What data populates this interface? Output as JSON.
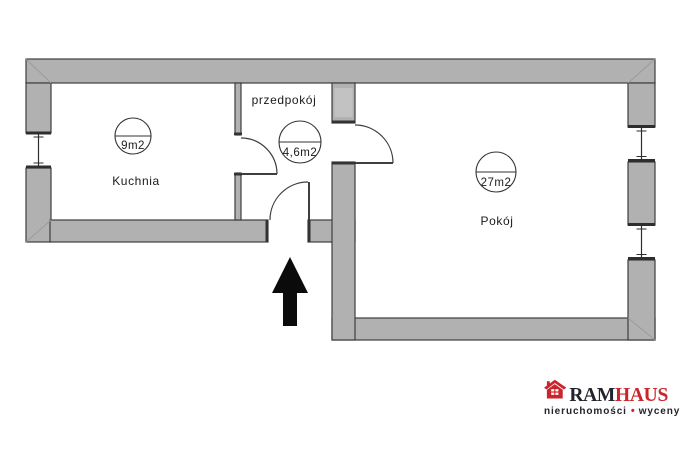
{
  "diagram": {
    "type": "floor-plan",
    "rooms": {
      "kitchen": {
        "name": "Kuchnia",
        "area": "9m2"
      },
      "hallway": {
        "name": "przedpokój",
        "area": "4,6m2"
      },
      "room": {
        "name": "Pokój",
        "area": "27m2"
      }
    },
    "icons": {
      "entrance_arrow": "arrow-up"
    },
    "colors": {
      "wall_fill": "#b1b1b1",
      "wall_outline": "#3e3e3e"
    }
  },
  "logo": {
    "icon": "house-icon",
    "brand_prefix": "RAM",
    "brand_suffix": "HAUS",
    "tagline_word1": "nieruchomości",
    "tagline_separator": "•",
    "tagline_word2": "wyceny",
    "colors": {
      "brand_red": "#c9252b",
      "brand_dark": "#23232b"
    }
  }
}
